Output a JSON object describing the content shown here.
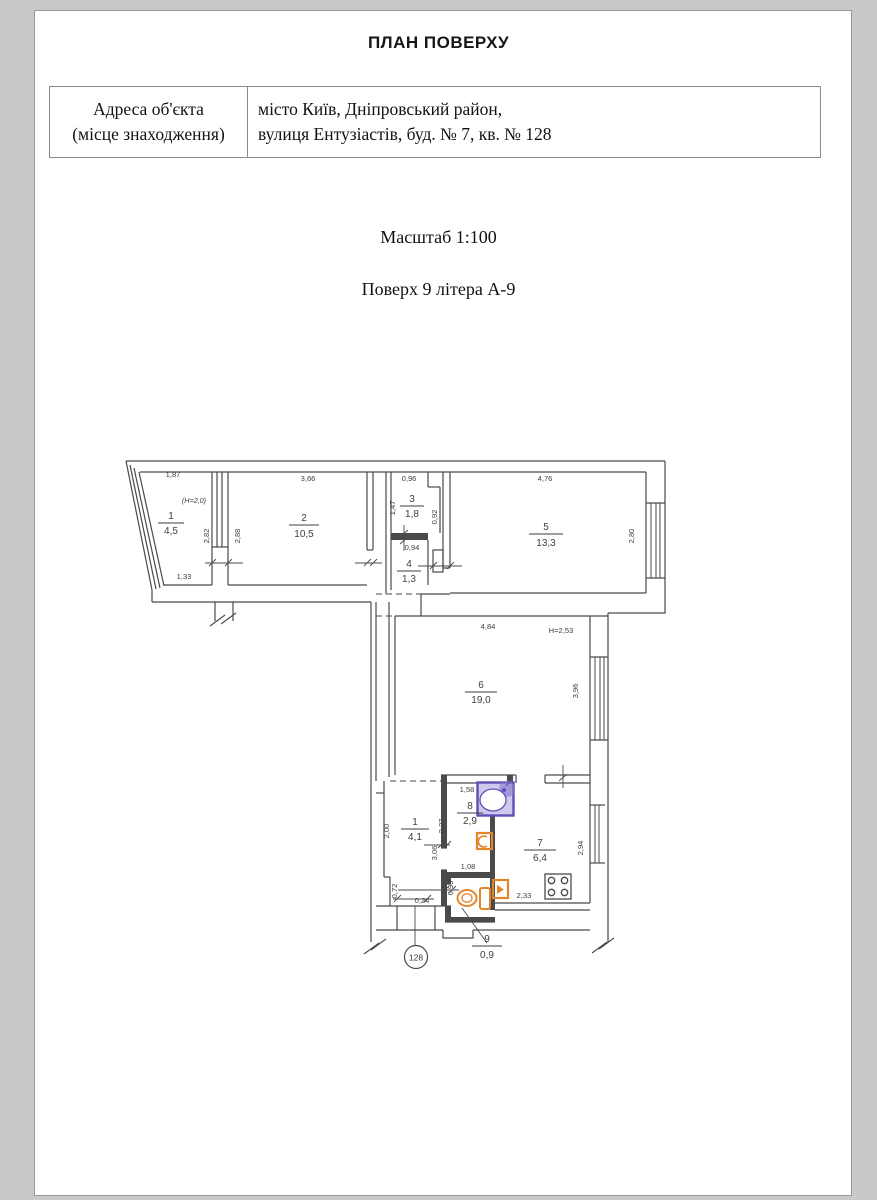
{
  "header": {
    "title": "ПЛАН ПОВЕРХУ"
  },
  "info_table": {
    "label_line1": "Адреса об'єкта",
    "label_line2": "(місце знаходження)",
    "value_line1": "місто Київ, Дніпровський район,",
    "value_line2": "вулиця Ентузіастів, буд. № 7, кв. № 128"
  },
  "scale_note": "Масштаб 1:100",
  "floor_note": "Поверх 9 літера А-9",
  "plan": {
    "apartment_number": "128",
    "height_note": "Н=2,53",
    "balcony_height_note": "(Н=2,0)",
    "rooms": [
      {
        "num": "1",
        "area": "4,5"
      },
      {
        "num": "2",
        "area": "10,5"
      },
      {
        "num": "3",
        "area": "1,8"
      },
      {
        "num": "4",
        "area": "1,3"
      },
      {
        "num": "5",
        "area": "13,3"
      },
      {
        "num": "6",
        "area": "19,0"
      },
      {
        "num": "1",
        "area": "4,1"
      },
      {
        "num": "8",
        "area": "2,9"
      },
      {
        "num": "7",
        "area": "6,4"
      },
      {
        "num": "9",
        "area": "0,9"
      }
    ],
    "dims": {
      "bal_top": "1,87",
      "bal_right": "2,82",
      "bal_bottom": "1,33",
      "r2_top": "3,66",
      "r2_left": "2,88",
      "r3_top": "0,96",
      "r3_left": "1,47",
      "r3_right": "0,92",
      "r4_top": "0,94",
      "r5_top": "4,76",
      "r5_right": "2,80",
      "r6_top": "4,84",
      "r6_right": "3,96",
      "hall_left": "2,00",
      "hall_left2": "0,72",
      "hall_bottom": "0,24",
      "hall_right": "3,06",
      "r8_top": "1,58",
      "r8_left": "2,27",
      "r8_bottom": "1,08",
      "r9_left": "0,93",
      "r7_right": "2,94",
      "r7_bottom": "2,33"
    }
  }
}
